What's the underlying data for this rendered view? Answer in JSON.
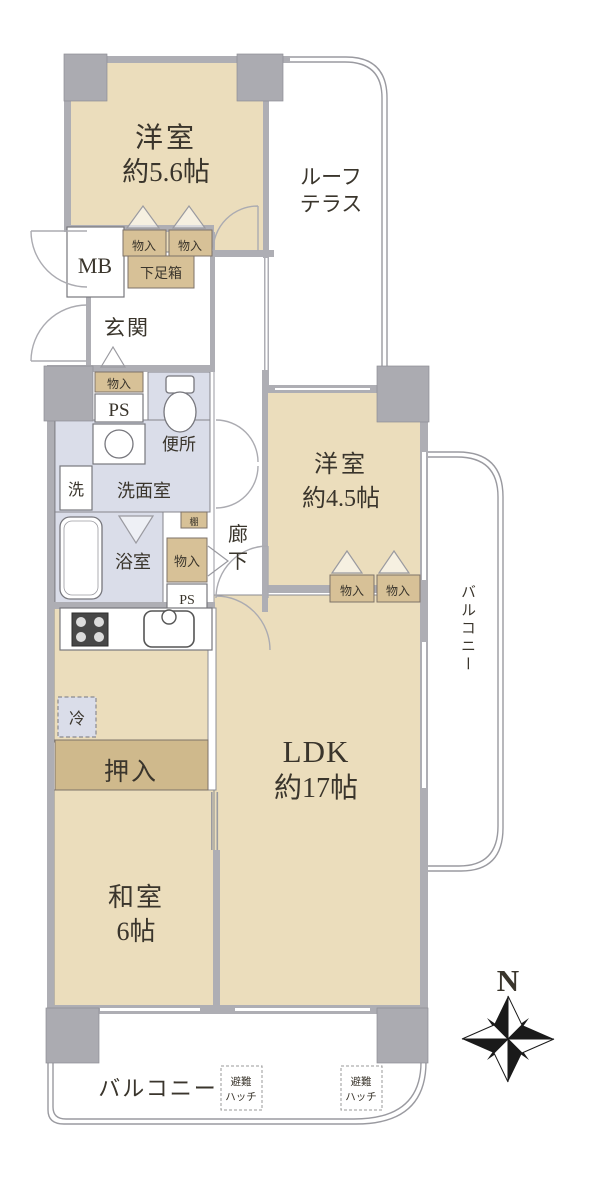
{
  "labels": {
    "room_west1_name": "洋室",
    "room_west1_size": "約5.6帖",
    "room_west2_name": "洋室",
    "room_west2_size": "約4.5帖",
    "room_ldk_name": "LDK",
    "room_ldk_size": "約17帖",
    "room_washitsu_name": "和室",
    "room_washitsu_size": "6帖",
    "roof_terrace_1": "ルーフ",
    "roof_terrace_2": "テラス",
    "balcony": "バルコニー",
    "genkan": "玄関",
    "corridor_1": "廊",
    "corridor_2": "下",
    "mb": "MB",
    "ps": "PS",
    "storage": "物入",
    "shoe_box": "下足箱",
    "shelf": "棚",
    "toilet": "便所",
    "washroom": "洗面室",
    "bathroom": "浴室",
    "laundry": "洗",
    "fridge": "冷",
    "oshiire": "押入",
    "hatch_1": "避難",
    "hatch_2": "ハッチ",
    "compass_north": "N"
  },
  "colors": {
    "room_fill": "#EBDDBC",
    "storage_fill": "#D7C197",
    "closet_fill": "#CFB98C",
    "wet_area_fill": "#DADDE9",
    "wall_fill": "#AEAEB4",
    "text": "#3A352C"
  }
}
